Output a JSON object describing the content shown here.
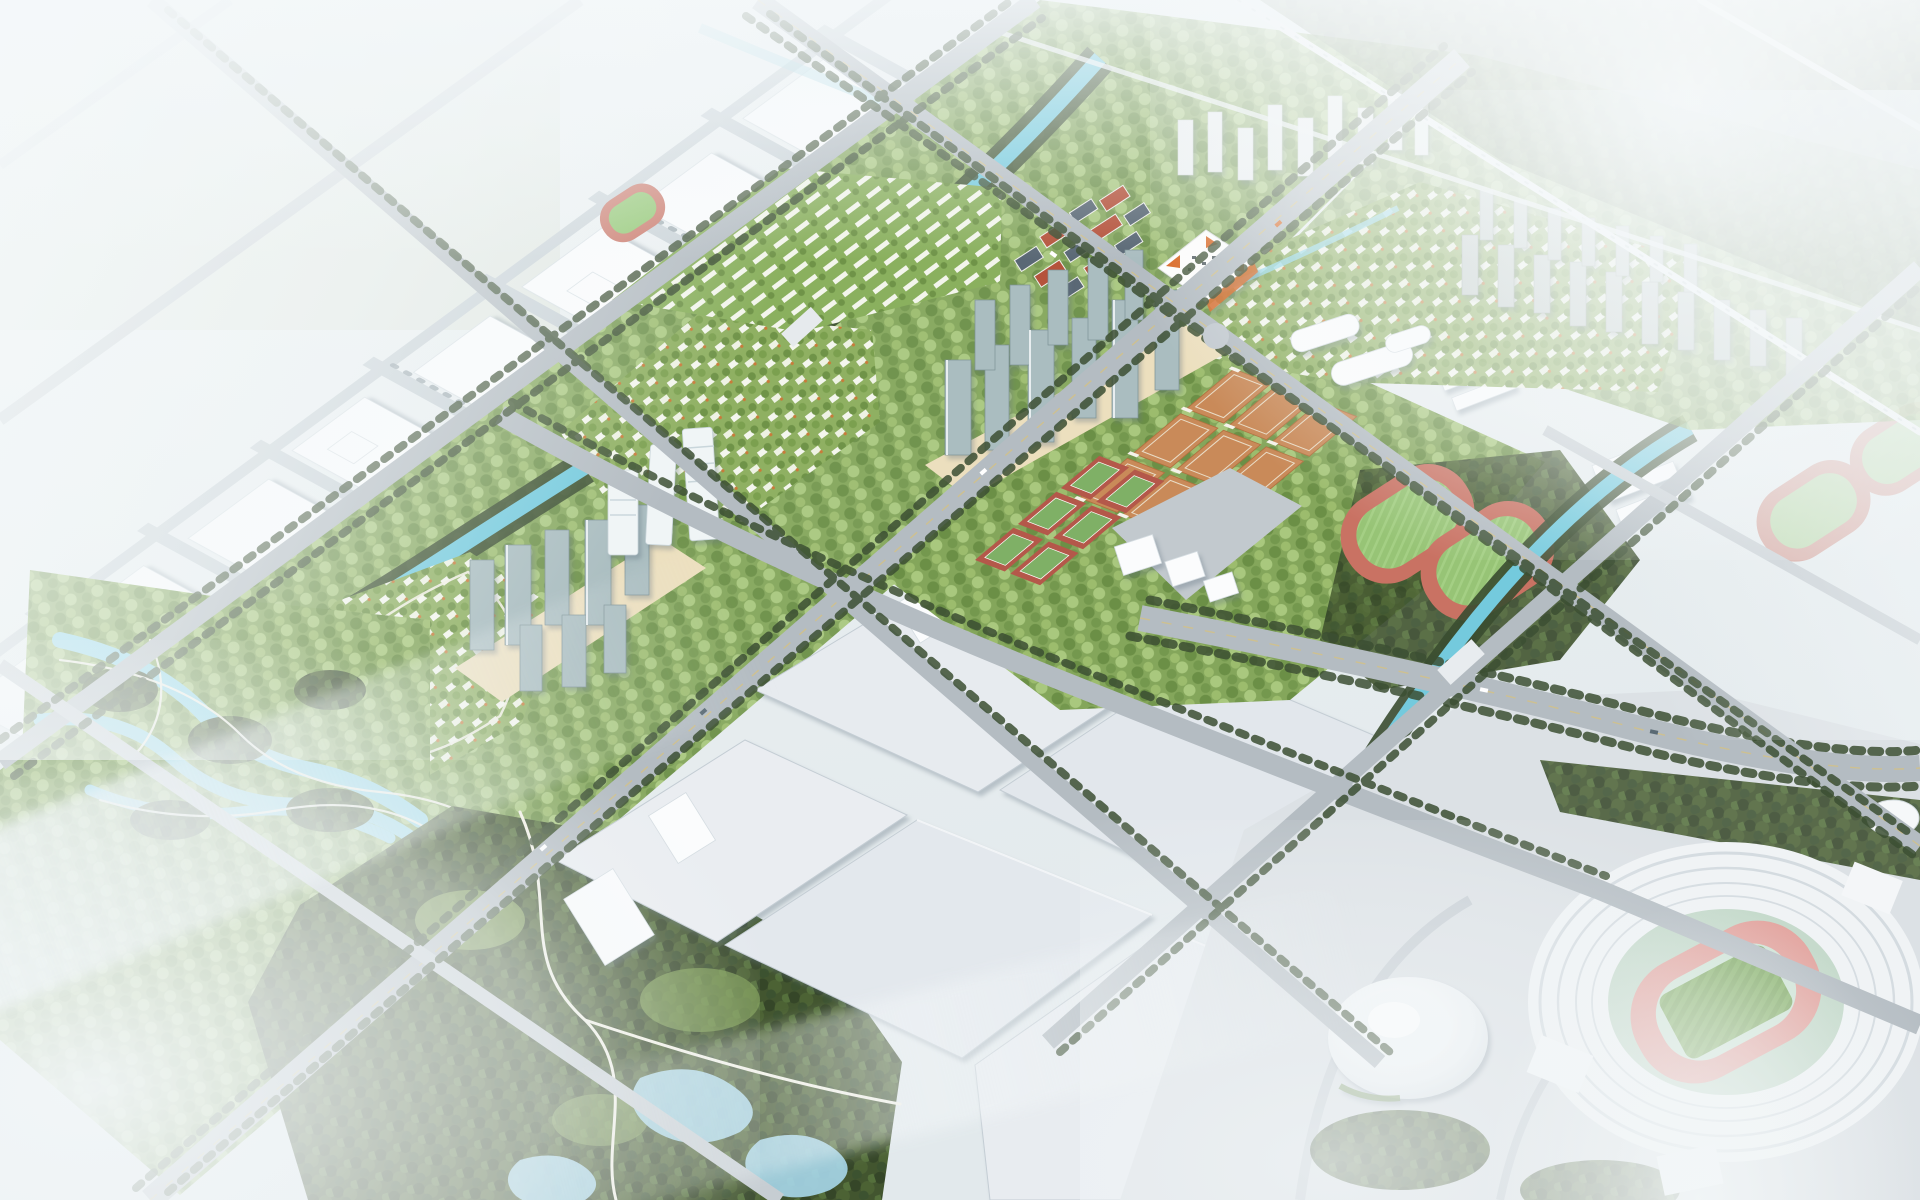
{
  "scene": {
    "title": "Aerial masterplan rendering of a mixed-use urban district",
    "style": "photorealistic bird's-eye architectural visualization with white fog at the edges",
    "regions": [
      {
        "id": "white-massing-district",
        "label": "White schematic city blocks (north-west)",
        "palette_key": "building_white"
      },
      {
        "id": "farmland",
        "label": "Pale fields beyond the district edge",
        "palette_key": "field"
      },
      {
        "id": "central-canal",
        "label": "Tree-lined canal crossing the green band",
        "palette_key": "water"
      },
      {
        "id": "wetland-park",
        "label": "Wetland park with lagoons, islands and loop trails",
        "palette_key": "pond"
      },
      {
        "id": "villa-communities",
        "label": "Low-rise villa neighbourhoods with green roofs",
        "palette_key": "villa_green"
      },
      {
        "id": "town-village",
        "label": "Pitched-roof town cluster (slate and red roofs)",
        "palette_key": "roof_red"
      },
      {
        "id": "canopy-pavilion",
        "label": "White canopy landmark with orange triangular accents",
        "palette_key": "canopy_orange"
      },
      {
        "id": "highrise-cluster-west",
        "label": "Residential high-rise cluster with beige podium (west)",
        "palette_key": "tower_glass"
      },
      {
        "id": "highrise-cluster-center",
        "label": "Residential high-rise cluster with beige podium (center)",
        "palette_key": "tower_glass"
      },
      {
        "id": "white-landmark-towers",
        "label": "White banded landmark towers by the canal",
        "palette_key": "building_white"
      },
      {
        "id": "basketball-courts",
        "label": "3 x 3 grid of clay-orange basketball courts with floodlights",
        "palette_key": "court_orange"
      },
      {
        "id": "tennis-courts",
        "label": "Green tennis courts with terracotta surrounds",
        "palette_key": "tennis_green"
      },
      {
        "id": "running-tracks",
        "label": "Two red athletics tracks with striped green infields",
        "palette_key": "track_red"
      },
      {
        "id": "school-campus",
        "label": "White slab school buildings beside the tracks",
        "palette_key": "building_white"
      },
      {
        "id": "exhibition-halls",
        "label": "Large flat-roofed exhibition / industrial halls (south)",
        "palette_key": "shed_roof"
      },
      {
        "id": "forest-park",
        "label": "Dense forest park with winding white trails and ponds",
        "palette_key": "forest"
      },
      {
        "id": "residential-towers-north",
        "label": "Rows of slab residential towers (north-east)",
        "palette_key": "tower_slab"
      },
      {
        "id": "arena-dome",
        "label": "White saucer-shaped arena",
        "palette_key": "building_white"
      },
      {
        "id": "main-stadium",
        "label": "Round stadium with red track and green pitch",
        "palette_key": "pitch_green"
      },
      {
        "id": "stadium-plaza",
        "label": "Large light-grey event plaza (south-east)",
        "palette_key": "plaza"
      },
      {
        "id": "railway-viaduct",
        "label": "Elevated railway viaduct fading into fog (north-east)",
        "palette_key": "road_light"
      },
      {
        "id": "highway",
        "label": "Tree-lined boulevard passing the stadium grounds",
        "palette_key": "road"
      }
    ],
    "atmosphere": {
      "fog": "soft white haze over all four corners and the far city",
      "lighting": "diffuse daylight"
    }
  },
  "palette": {
    "mist": "#f4f7f8",
    "ground": "#e8edef",
    "field": "#dde4d8",
    "building_white": "#fbfcfd",
    "building_shadow": "#c9d2d8",
    "water": "#74cadd",
    "pond": "#a7d7ea",
    "lawn": "#8fae62",
    "lawn_bright": "#9cc06f",
    "villa_green": "#8fb062",
    "forest": "#42552f",
    "road": "#b4bcc2",
    "road_light": "#cdd3d8",
    "plaza": "#dce1e5",
    "shed_roof": "#e4e9ed",
    "court_orange": "#c98a59",
    "tennis_green": "#7fb066",
    "tennis_surround": "#b4584a",
    "track_red": "#c97263",
    "track_infield": "#97c476",
    "stadium_track": "#e2a09a",
    "stadium_apron": "#c2d8c8",
    "pitch_green": "#7ca65f",
    "tower_glass": "#aabdc0",
    "tower_slab": "#bfc9c6",
    "canopy_orange": "#d8641f",
    "roof_red": "#b5533c",
    "roof_slate": "#5a6875",
    "podium_beige": "#ecdfbe",
    "sand": "#e8d9a8",
    "trail": "#f3f1e6"
  }
}
